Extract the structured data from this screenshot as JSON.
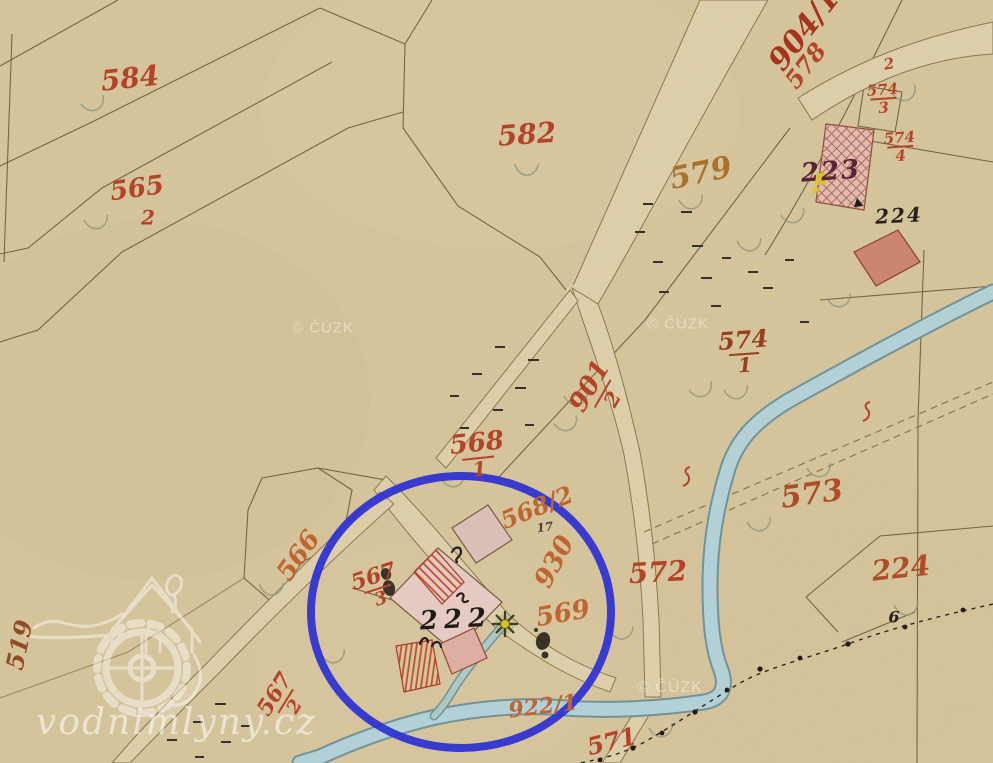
{
  "map": {
    "kind": "historical cadastral map scan with mill site highlighted",
    "labels": {
      "p584": "584",
      "p565_num": "565",
      "p565_den": "2",
      "p582": "582",
      "p904_1": "904/1",
      "p578": "578",
      "p574_3_num": "574",
      "p574_3_den": "3",
      "p574_4_num": "574",
      "p574_4_den": "4",
      "p2_small": "2",
      "h223": "223",
      "h224_top": "224",
      "p579": "579",
      "p574_1_num": "574",
      "p574_1_den": "1",
      "p901_2_num": "901",
      "p901_2_den": "2",
      "p568_1_num": "568",
      "p568_1_den": "1",
      "p566": "566",
      "p567_3_num": "567",
      "p567_3_den": "3",
      "p568_2": "568/2",
      "p930": "930",
      "h222": "222",
      "p569": "569",
      "p572": "572",
      "p573": "573",
      "p224_br": "224",
      "p567_2_num": "567",
      "p567_2_den": "2",
      "p922_1": "922/1",
      "p571": "571",
      "p519": "519",
      "h6": "6",
      "p17": "17"
    }
  },
  "watermarks": {
    "site_text": "vodnimlyny.cz",
    "cuzk": "© ČÚZK",
    "logo_icon": "watermill-house-waterwheel-icon"
  },
  "annotation": {
    "shape": "highlight-circle",
    "color": "#2b2fd4"
  },
  "palette": {
    "paper": "#d6c59c",
    "road": "#ded0ab",
    "water": "#b4d2d8",
    "building_pink": "#e2bdb2",
    "building_red": "#cd8672",
    "parcel_red": "#b5432a",
    "parcel_orange": "#bf6530",
    "ink_black": "#241c16",
    "annotation_blue": "#2b2fd4"
  }
}
